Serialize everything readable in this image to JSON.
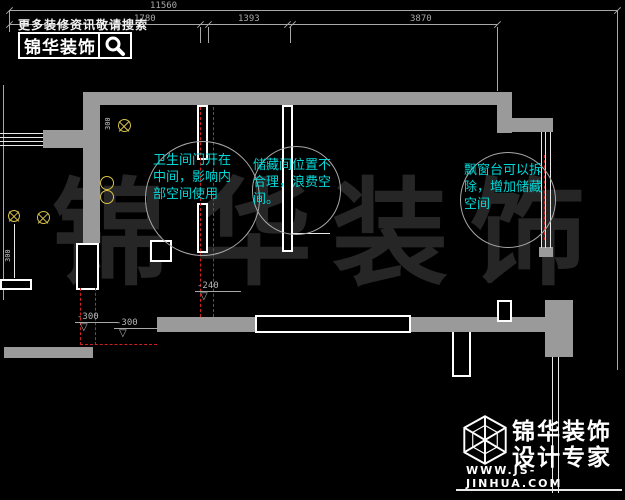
{
  "header": {
    "slogan": "更多装修资讯敬请搜索",
    "logo_text": "锦华装饰"
  },
  "dimensions": {
    "total": "11560",
    "seg1": "1780",
    "seg2": "1393",
    "seg3": "3870"
  },
  "plan": {
    "levels": {
      "m1": "-240",
      "m2": "-300",
      "m3": "-300"
    },
    "risers": {
      "r1": "300",
      "r2": "300"
    },
    "bubbles": {
      "bathroom": "卫生间门开在\n中间，影响内\n部空间使用",
      "storage": "储藏间位置不\n合理，浪费空\n间。",
      "baywindow": "飘窗台可以拆\n除，增加储藏\n空间"
    }
  },
  "watermark": {
    "c1": "锦",
    "c2": "华",
    "c3": "装",
    "c4": "饰"
  },
  "footer": {
    "brand": "锦华装饰",
    "tagline": "设计专家",
    "url": "WWW.JS-JINHUA.COM"
  },
  "icons": {
    "level_triangle": "▽"
  },
  "colors": {
    "wall_gray": "#9a9a9a",
    "annotation_cyan": "#00d9d9",
    "demolition_red": "#cf1f1f",
    "symbol_yellow": "#d9c34a",
    "watermark_gray": "#262626"
  }
}
